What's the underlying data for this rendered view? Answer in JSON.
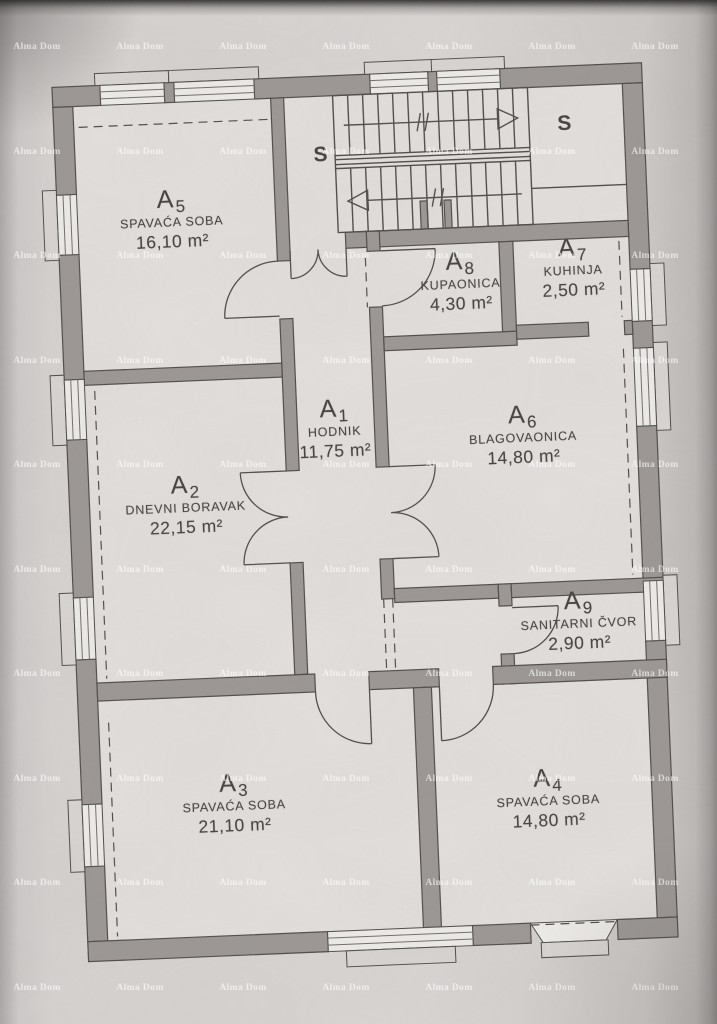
{
  "watermark": {
    "text": "Alma Dom"
  },
  "colors": {
    "paper": "#d9d5d3",
    "floor": "#e6e2df",
    "wall": "#9a9592",
    "line": "#4a4643",
    "text": "#3e3b38",
    "watermark": "rgba(255,255,255,0.62)"
  },
  "plan": {
    "stairs": {
      "label": "S"
    },
    "rooms": [
      {
        "id": "A",
        "sub": "1",
        "name": "HODNIK",
        "area": "11,75 m²"
      },
      {
        "id": "A",
        "sub": "2",
        "name": "DNEVNI BORAVAK",
        "area": "22,15 m²"
      },
      {
        "id": "A",
        "sub": "3",
        "name": "SPAVAĆA SOBA",
        "area": "21,10 m²"
      },
      {
        "id": "A",
        "sub": "4",
        "name": "SPAVAĆA SOBA",
        "area": "14,80 m²"
      },
      {
        "id": "A",
        "sub": "5",
        "name": "SPAVAĆA SOBA",
        "area": "16,10 m²"
      },
      {
        "id": "A",
        "sub": "6",
        "name": "BLAGOVAONICA",
        "area": "14,80 m²"
      },
      {
        "id": "A",
        "sub": "7",
        "name": "KUHINJA",
        "area": "2,50 m²"
      },
      {
        "id": "A",
        "sub": "8",
        "name": "KUPAONICA",
        "area": "4,30 m²"
      },
      {
        "id": "A",
        "sub": "9",
        "name": "SANITARNI ČVOR",
        "area": "2,90 m²"
      }
    ]
  }
}
